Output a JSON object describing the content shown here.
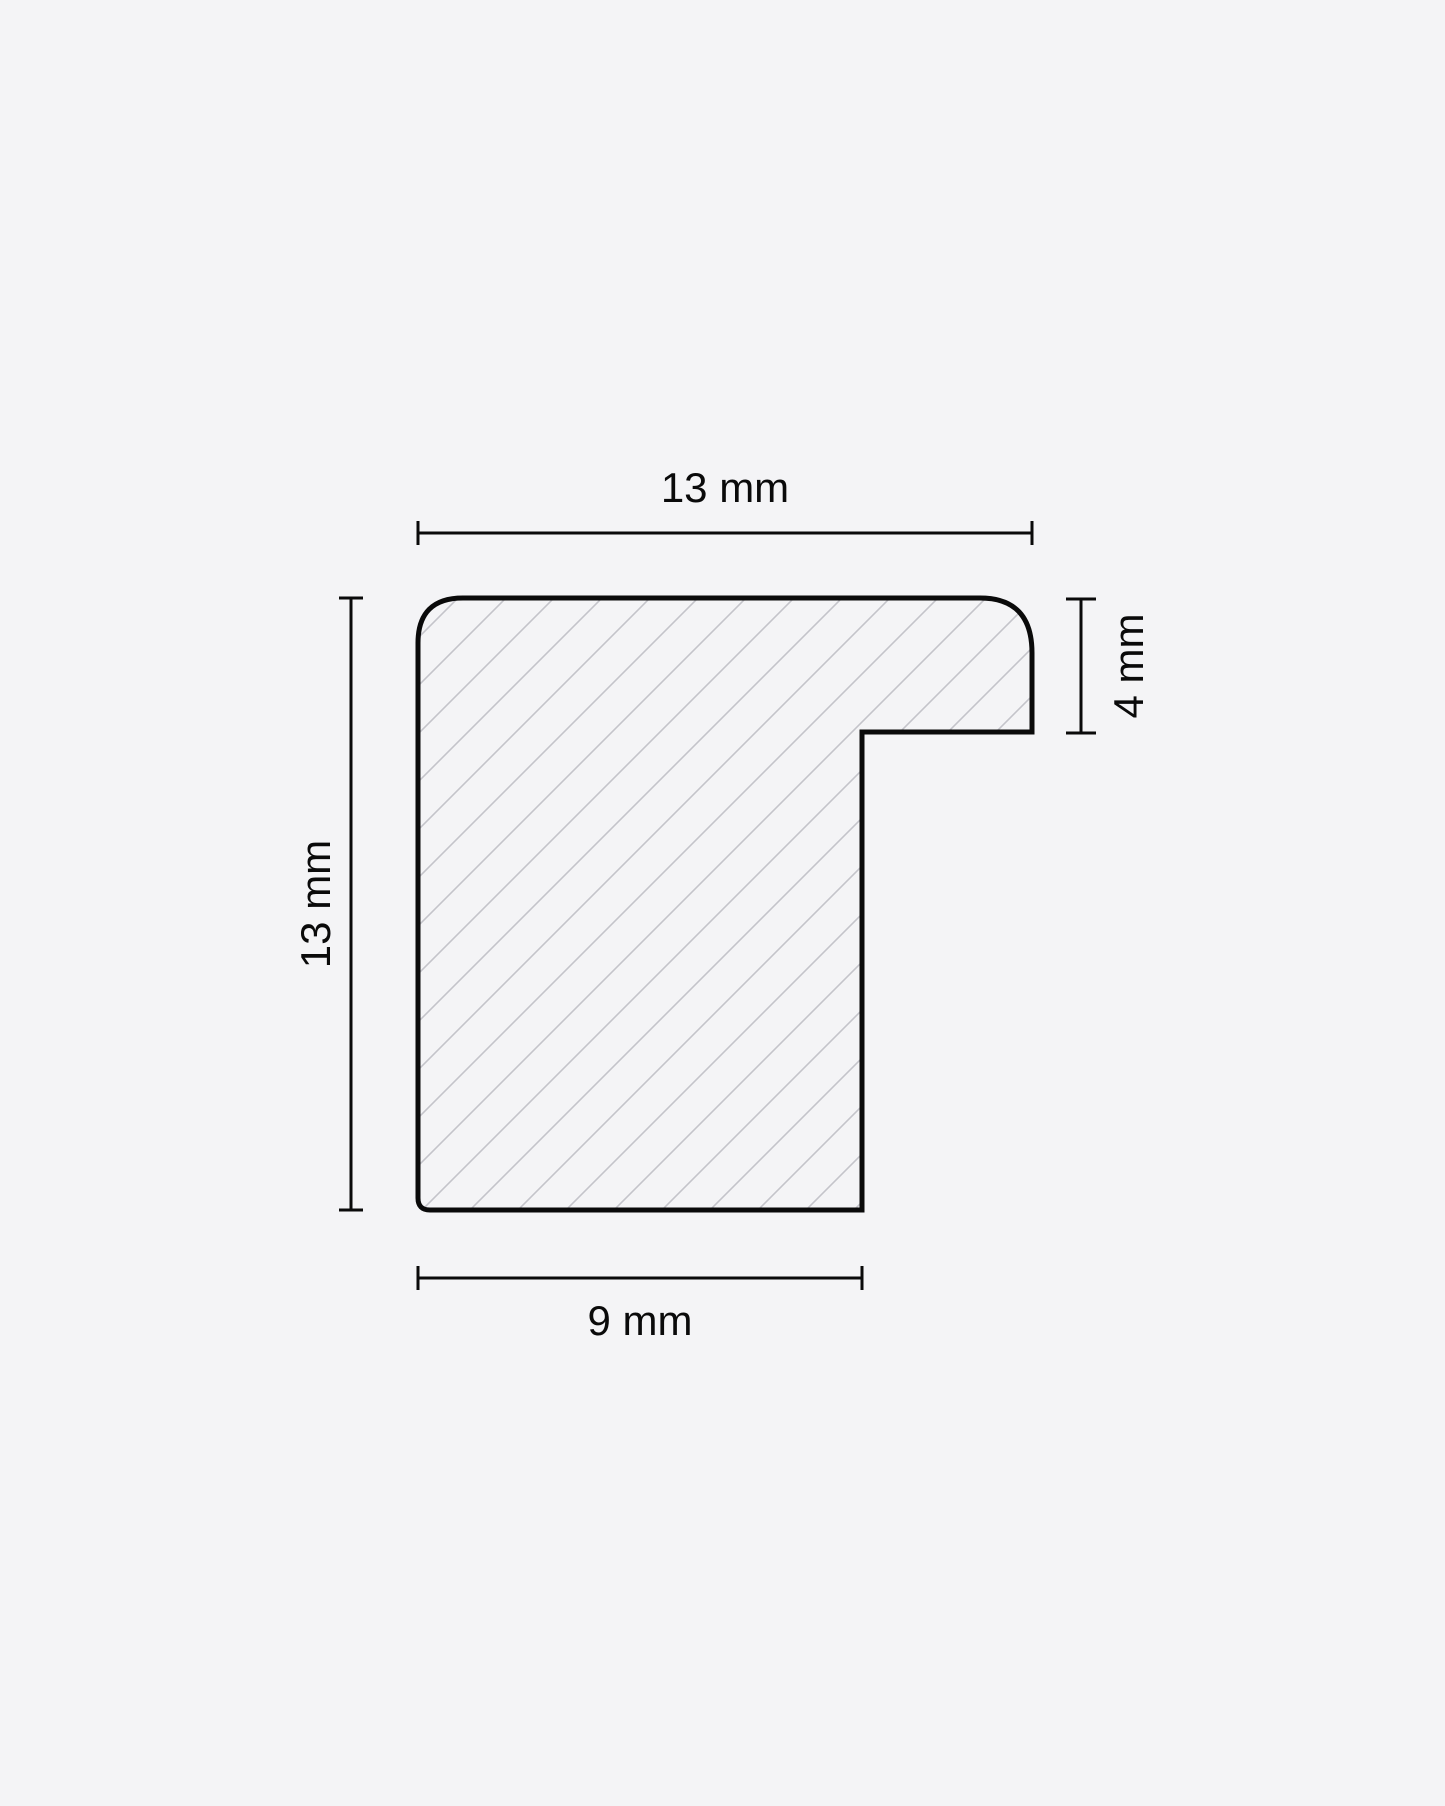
{
  "colors": {
    "background": "#f4f4f6",
    "ink": "#0a0a0a",
    "outline": "#0a0a0a",
    "hatch": "#c4c4ca"
  },
  "drawing": {
    "description": "Cross-section profile with diagonal hatching and four dimension callouts",
    "dimensions": {
      "top": {
        "label": "13 mm"
      },
      "left": {
        "label": "13 mm"
      },
      "right": {
        "label": "4 mm"
      },
      "bottom": {
        "label": "9 mm"
      }
    }
  }
}
